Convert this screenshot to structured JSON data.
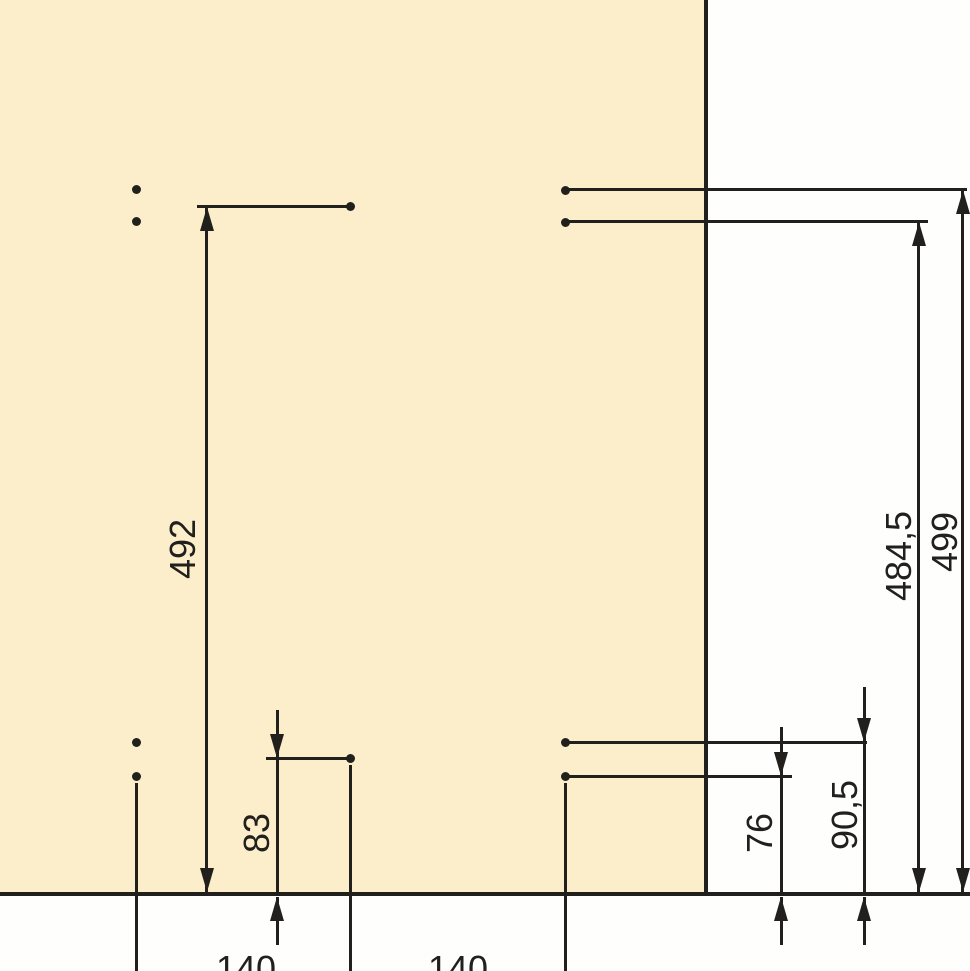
{
  "drawing": {
    "panel_color": "#fdeecb",
    "background_color": "#fefefd",
    "line_color": "#21201d",
    "labels": {
      "left_height": "492",
      "right_height_inner": "484,5",
      "right_height_outer": "499",
      "bottom_left_offset": "83",
      "bottom_right_inner": "76",
      "bottom_right_outer": "90,5",
      "bottom_spacing_left": "140",
      "bottom_spacing_right": "140"
    }
  }
}
